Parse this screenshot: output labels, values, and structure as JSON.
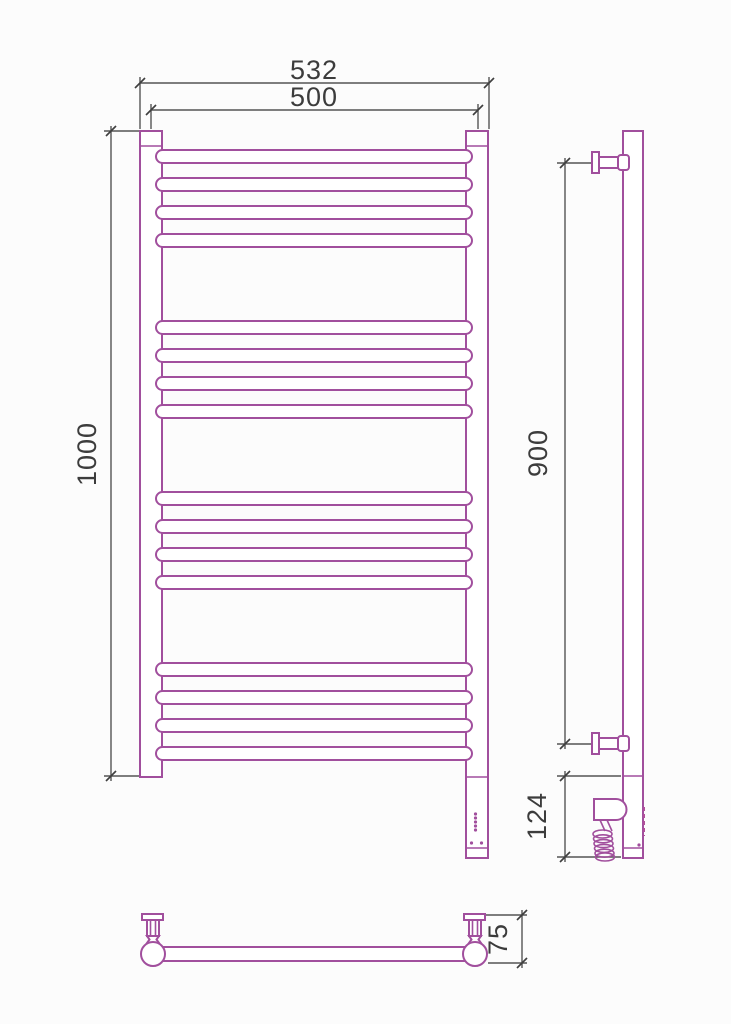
{
  "colors": {
    "outline": "#a14f9d",
    "dimension_lines": "#555555",
    "dimension_text": "#3c3c3c",
    "background": "#fcfcfc"
  },
  "dimensions": {
    "overall_width": {
      "value": "532",
      "orientation": "horizontal"
    },
    "mounting_width": {
      "value": "500",
      "orientation": "horizontal"
    },
    "overall_height": {
      "value": "1000",
      "orientation": "vertical"
    },
    "bracket_span": {
      "value": "900",
      "orientation": "vertical"
    },
    "heater_section_height": {
      "value": "124",
      "orientation": "vertical"
    },
    "wall_depth": {
      "value": "75",
      "orientation": "vertical"
    }
  },
  "front_view": {
    "rung_count": 16,
    "rung_groups": 4,
    "rungs_per_group": 4,
    "rung_layout": {
      "x": 156,
      "width": 316,
      "height": 13,
      "radius": 6.5,
      "pitch": 28,
      "group_tops": [
        150,
        321,
        492,
        663
      ]
    },
    "led_indicator_dots": 5
  },
  "side_view": {
    "wall_brackets": 2,
    "heating_element": true,
    "coiled_cable": true
  },
  "top_view": {
    "wall_brackets": 2,
    "rail_circles": 2
  }
}
